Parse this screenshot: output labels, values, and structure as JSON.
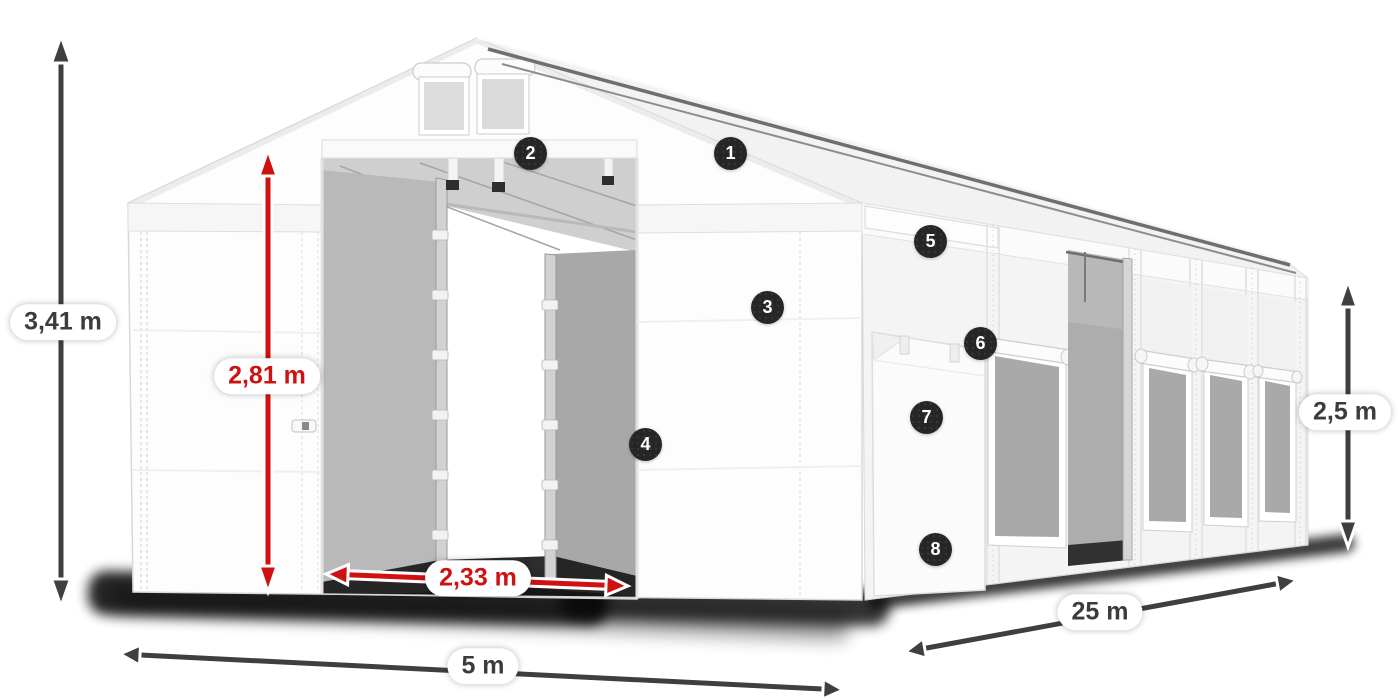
{
  "dimensions": {
    "total_height": "3,41 m",
    "entrance_height": "2,81 m",
    "entrance_width": "2,33 m",
    "front_width": "5 m",
    "side_length": "25 m",
    "side_height": "2,5 m"
  },
  "badges": [
    {
      "number": "1"
    },
    {
      "number": "2"
    },
    {
      "number": "3"
    },
    {
      "number": "4"
    },
    {
      "number": "5"
    },
    {
      "number": "6"
    },
    {
      "number": "7"
    },
    {
      "number": "8"
    }
  ],
  "colors": {
    "dimension_red": "#ce1212",
    "dimension_dark": "#3f3f3f",
    "badge_background": "#262626",
    "badge_text": "#ffffff",
    "tent_white": "#fcfcfc",
    "interior_gray": "#adadad",
    "mesh_gray": "#a9a9a9",
    "shadow_black": "#070707"
  }
}
